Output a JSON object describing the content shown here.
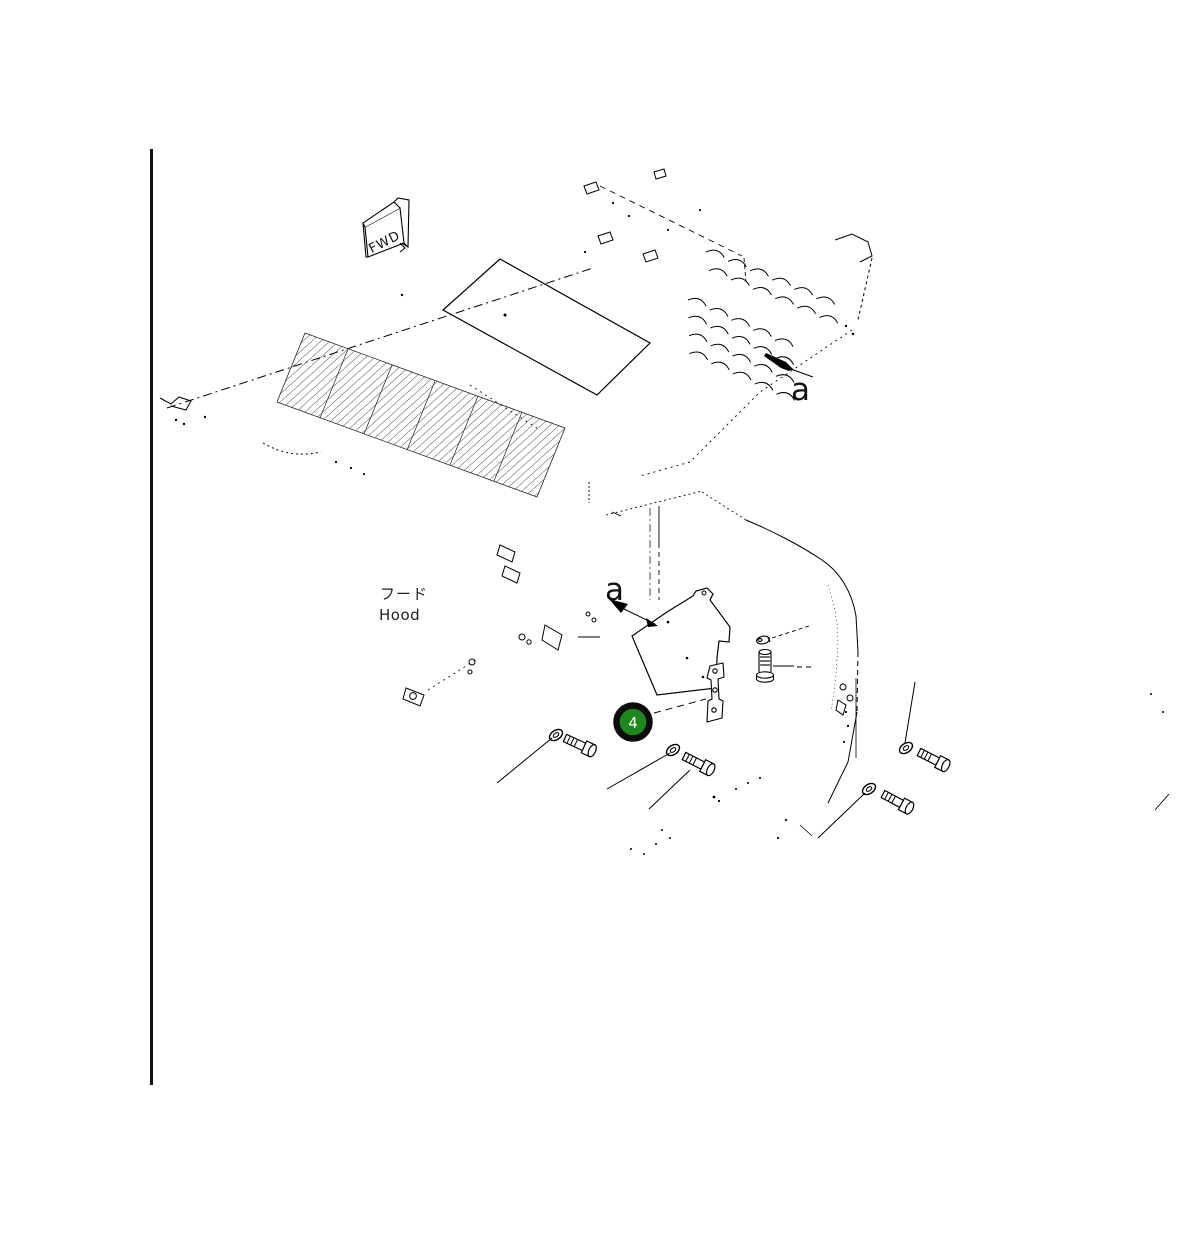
{
  "page": {
    "background": "#ffffff",
    "ink": "#000000"
  },
  "top_view": {
    "fwd_plate_label": "FWD",
    "view_arrow_label": "a"
  },
  "detail_view": {
    "view_arrow_label": "a",
    "part_name_ja": "フード",
    "part_name_en": "Hood"
  },
  "callout": {
    "number": "4",
    "fill": "#1e871e",
    "ring": "#0d0d0d",
    "number_color": "#ffffff"
  }
}
